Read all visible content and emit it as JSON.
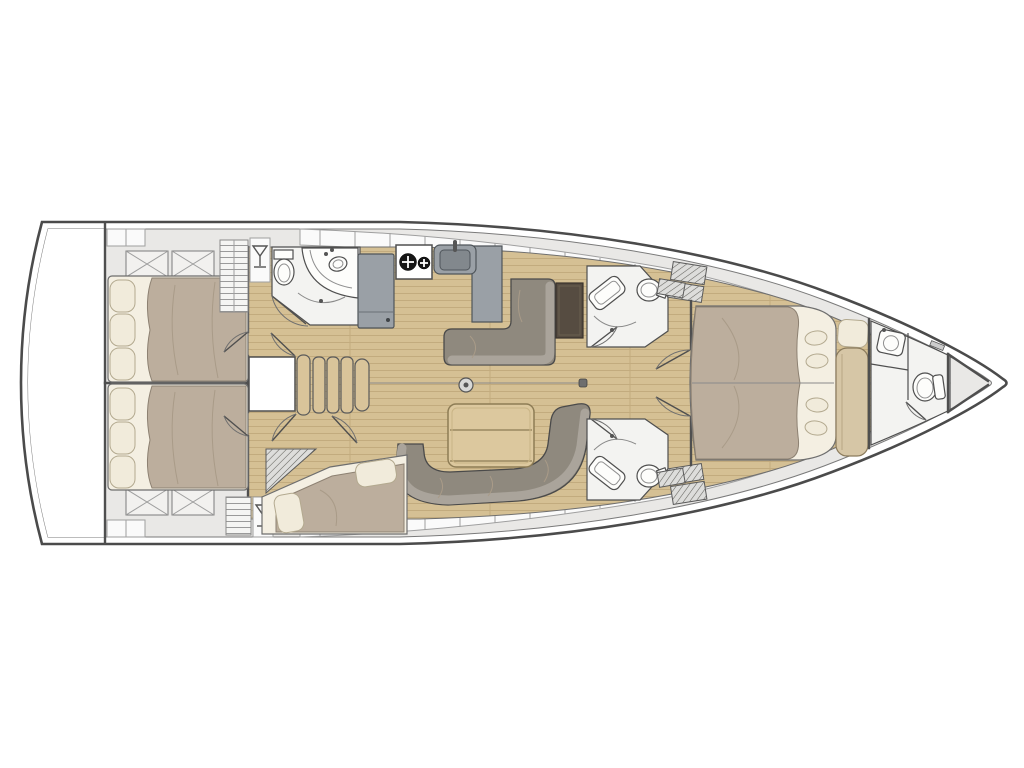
{
  "page": {
    "alt_text": "Top-down interior layout plan of a sailing yacht, bow pointing right, on a white background"
  },
  "colors": {
    "page_bg": "#ffffff",
    "hull_outline": "#4b4b4b",
    "hull_fill": "#ffffff",
    "deck": "#e9e8e6",
    "locker": "#fafafa",
    "locker_border": "#9f9f9f",
    "wood": "#d5c094",
    "wood_line": "#c2ab7e",
    "wood_table": "#dcc89e",
    "stair": "#d9c49a",
    "duvet": "#bcae9d",
    "mattress": "#f4efe2",
    "pillow": "#f1ebdb",
    "pillow_border": "#b3a98f",
    "sofa_seat": "#8f897e",
    "sofa_back": "#aaa49b",
    "counter": "#9aa0a6",
    "dark_desk": "#564c41",
    "fixture": "#fdfdfb",
    "head_floor": "#f3f3f1",
    "line": "#4f4f4f",
    "line_soft": "#8a8a8a",
    "bench": "#d6c6a6"
  },
  "inventory": {
    "double_berths": 4,
    "heads": 4,
    "toilets": 4,
    "sinks": 5,
    "stove_burners": 2,
    "companionway_steps": 5,
    "salon_tables": 1,
    "nav_desks": 1,
    "sofas": 2
  }
}
